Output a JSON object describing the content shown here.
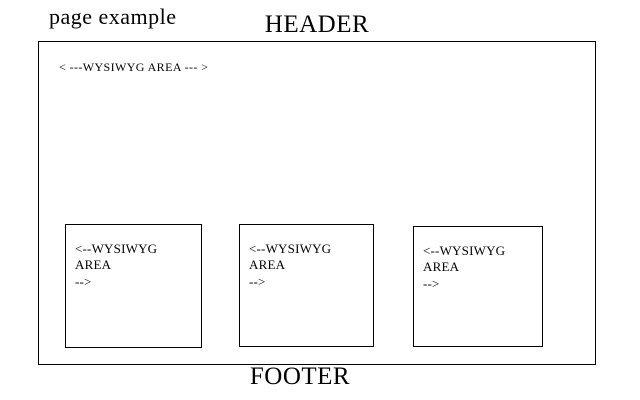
{
  "page": {
    "title": "page example",
    "header_label": "HEADER",
    "footer_label": "FOOTER"
  },
  "canvas": {
    "main_area_label": "< ---WYSIWYG AREA --- >",
    "boxes": [
      {
        "label": "<--WYSIWYG AREA\n-->"
      },
      {
        "label": "<--WYSIWYG AREA\n-->"
      },
      {
        "label": "<--WYSIWYG AREA\n-->"
      }
    ]
  },
  "colors": {
    "background": "#ffffff",
    "border": "#000000",
    "text": "#000000"
  }
}
